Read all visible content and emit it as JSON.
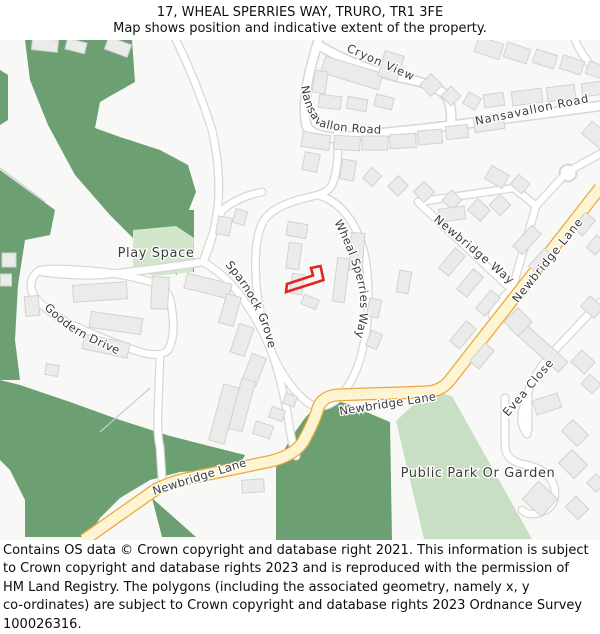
{
  "header": {
    "title": "17, WHEAL SPERRIES WAY, TRURO, TR1 3FE",
    "subtitle": "Map shows position and indicative extent of the property."
  },
  "map": {
    "labels": {
      "cryon_view": "Cryon View",
      "nansavallon_left": "Nansavallon Road",
      "nansavallon_right": "Nansavallon Road",
      "newbridge_way": "Newbridge Way",
      "newbridge_lane_diagonal": "Newbridge Lane",
      "newbridge_lane_horizontal": "Newbridge Lane",
      "newbridge_lane_lower": "Newbridge Lane",
      "wheal_sperries_way": "Wheal Sperries Way",
      "sparnock_grove": "Sparnock Grove",
      "goodern_drive": "Goodern Drive",
      "evea_close": "Evea Close",
      "play_space": "Play Space",
      "public_park": "Public Park Or Garden"
    },
    "colors": {
      "woodland": "#6c9f72",
      "parkland": "#c9dfc4",
      "play_space": "#d2e6cb",
      "road_fill": "#ffffff",
      "road_casing": "#d7d7d6",
      "primary_road_fill": "#fdf4d2",
      "primary_road_casing": "#eca63d",
      "building_fill": "#ebebea",
      "building_stroke": "#d2d2d1",
      "background": "#f8f8f7",
      "plot_outline": "#e4251f",
      "label_text": "#3b3b3b"
    }
  },
  "footer": {
    "lines": [
      "Contains OS data © Crown copyright and database right 2021. This information is subject",
      "to Crown copyright and database rights 2023 and is reproduced with the permission of",
      "HM Land Registry. The polygons (including the associated geometry, namely x, y",
      "co-ordinates) are subject to Crown copyright and database rights 2023 Ordnance Survey",
      "100026316."
    ]
  }
}
